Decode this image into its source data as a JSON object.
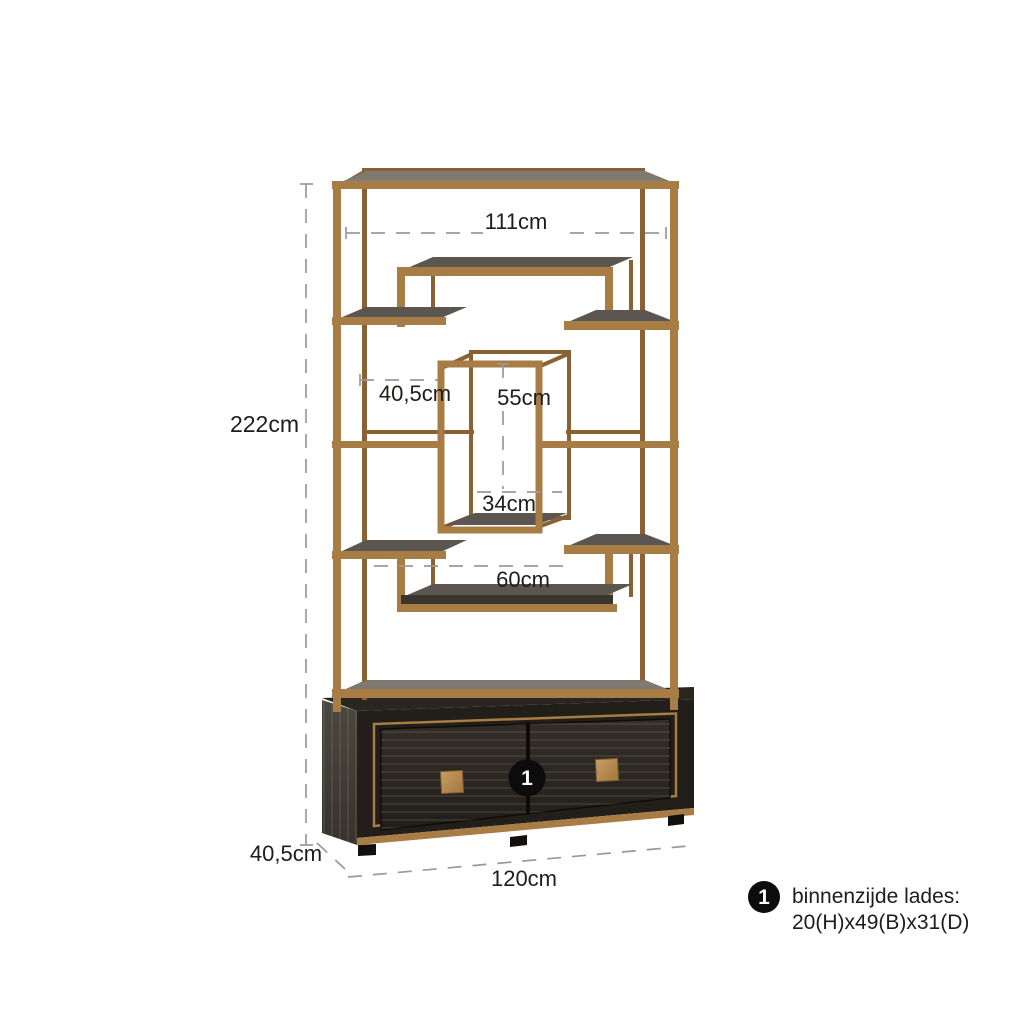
{
  "diagram": {
    "background": "#ffffff",
    "product": "etagere-with-drawer-base",
    "marker_badge": "1",
    "labels": {
      "height_total": "222cm",
      "width_top_inner": "111cm",
      "shelf_depth": "40,5cm",
      "inner_box_height": "55cm",
      "inner_box_width": "34cm",
      "lower_shelf_width": "60cm",
      "base_depth": "40,5cm",
      "base_width": "120cm"
    },
    "legend": {
      "marker": "1",
      "title": "binnenzijde lades:",
      "value": "20(H)x49(B)x31(D)"
    },
    "colors": {
      "css_vars": "--brass:#a87c45;--brass-light:#c49a62;--brass-dark:#8a6132;--wood-grey:#7d7870;--wood-grey-dark:#5b5650;--wood-dark:#3a352f;--base-side:#45413a;--base-front:#221e19;--base-edge:#12100c;--drawer:#2f2b25;--dash:#999999;--ink:#1d1d1b;--badge:#0c0c0c",
      "brass_frame": "#a87c45",
      "shelf_wood": "#5b5650",
      "base_cabinet": "#221e19",
      "dimension_lines": "#999999",
      "label_text": "#1d1d1b",
      "marker_badge_bg": "#0c0c0c"
    }
  }
}
